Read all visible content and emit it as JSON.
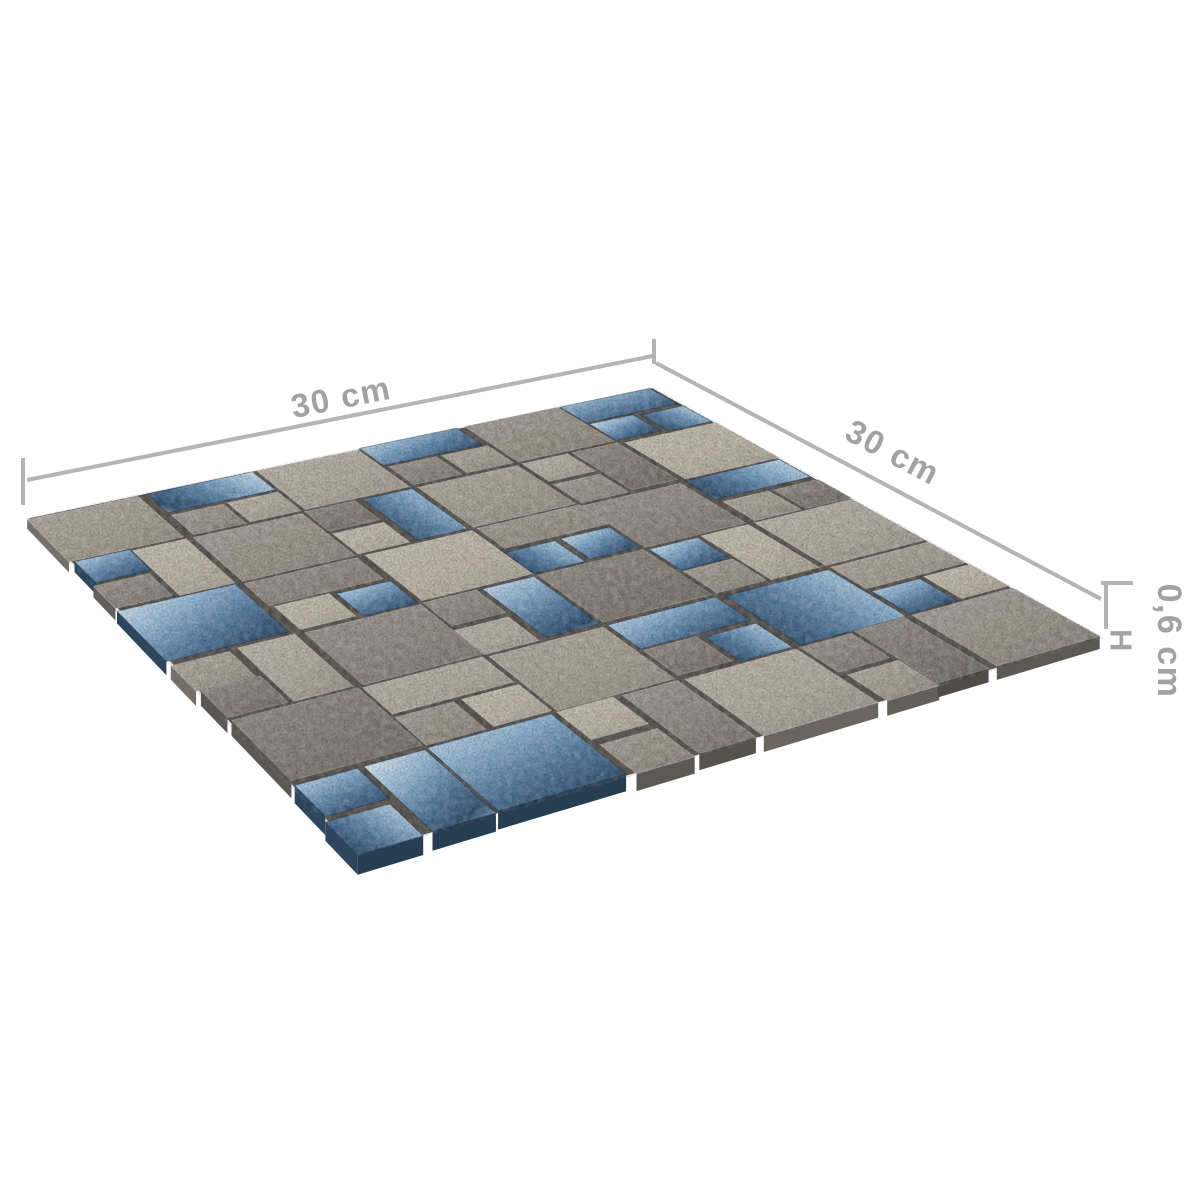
{
  "figure": {
    "type": "product-dimension-diagram",
    "product": "mosaic-tile-sheet",
    "background_color": "#ffffff",
    "sheet": {
      "corners": {
        "west": [
          25,
          518
        ],
        "north": [
          653,
          387
        ],
        "east": [
          1105,
          638
        ],
        "south": [
          358,
          856
        ]
      },
      "grid_units": 12,
      "grout_color": "#57524c",
      "stone_shades": [
        "#837d75",
        "#8f8880",
        "#9a938a",
        "#a59e94",
        "#b1a99f",
        "#bdb4a6"
      ],
      "glass_colors": {
        "light": "#dcebf5",
        "mid": "#93b7d4",
        "dark": "#54799e",
        "deep": "#31516f"
      },
      "edge_thickness_px": {
        "far": 5,
        "near": 20
      }
    },
    "tile_format": "[row, col, width, height, type(s=stone,g=glass), shade-or-glass-variant]",
    "tiles": [
      [
        0,
        0,
        2,
        2,
        "s",
        3
      ],
      [
        0,
        2,
        2,
        1,
        "g",
        1
      ],
      [
        1,
        2,
        1,
        1,
        "s",
        2
      ],
      [
        1,
        3,
        1,
        1,
        "s",
        4
      ],
      [
        2,
        0,
        1,
        1,
        "g",
        0
      ],
      [
        3,
        0,
        1,
        1,
        "s",
        1
      ],
      [
        2,
        1,
        1,
        2,
        "s",
        5
      ],
      [
        2,
        2,
        2,
        2,
        "s",
        2
      ],
      [
        0,
        4,
        2,
        2,
        "s",
        4
      ],
      [
        0,
        6,
        2,
        1,
        "g",
        2
      ],
      [
        1,
        6,
        1,
        1,
        "s",
        1
      ],
      [
        1,
        7,
        1,
        1,
        "s",
        3
      ],
      [
        2,
        4,
        1,
        1,
        "s",
        0
      ],
      [
        3,
        4,
        1,
        1,
        "s",
        5
      ],
      [
        2,
        5,
        1,
        2,
        "g",
        1
      ],
      [
        2,
        6,
        2,
        2,
        "s",
        3
      ],
      [
        0,
        8,
        2,
        2,
        "s",
        2
      ],
      [
        0,
        10,
        2,
        1,
        "g",
        0
      ],
      [
        1,
        10,
        1,
        1,
        "g",
        2
      ],
      [
        1,
        11,
        1,
        1,
        "g",
        1
      ],
      [
        2,
        8,
        1,
        1,
        "s",
        4
      ],
      [
        3,
        8,
        1,
        1,
        "s",
        2
      ],
      [
        2,
        9,
        1,
        2,
        "s",
        0
      ],
      [
        2,
        10,
        2,
        2,
        "s",
        5
      ],
      [
        4,
        0,
        2,
        2,
        "g",
        2
      ],
      [
        4,
        2,
        2,
        1,
        "s",
        1
      ],
      [
        5,
        2,
        1,
        1,
        "s",
        5
      ],
      [
        5,
        3,
        1,
        1,
        "g",
        0
      ],
      [
        6,
        0,
        1,
        1,
        "s",
        3
      ],
      [
        7,
        0,
        1,
        1,
        "s",
        0
      ],
      [
        6,
        1,
        1,
        2,
        "s",
        4
      ],
      [
        6,
        2,
        2,
        2,
        "s",
        1
      ],
      [
        4,
        4,
        2,
        2,
        "s",
        5
      ],
      [
        4,
        6,
        2,
        1,
        "s",
        2
      ],
      [
        5,
        6,
        1,
        1,
        "g",
        1
      ],
      [
        5,
        7,
        1,
        1,
        "g",
        2
      ],
      [
        6,
        4,
        1,
        1,
        "s",
        1
      ],
      [
        7,
        4,
        1,
        1,
        "s",
        4
      ],
      [
        6,
        5,
        1,
        2,
        "g",
        0
      ],
      [
        6,
        6,
        2,
        2,
        "s",
        0
      ],
      [
        4,
        8,
        2,
        2,
        "s",
        1
      ],
      [
        4,
        10,
        2,
        1,
        "g",
        1
      ],
      [
        5,
        10,
        1,
        1,
        "s",
        3
      ],
      [
        5,
        11,
        1,
        1,
        "s",
        0
      ],
      [
        6,
        8,
        1,
        1,
        "g",
        2
      ],
      [
        7,
        8,
        1,
        1,
        "s",
        2
      ],
      [
        6,
        9,
        1,
        2,
        "s",
        5
      ],
      [
        6,
        10,
        2,
        2,
        "s",
        4
      ],
      [
        8,
        0,
        2,
        2,
        "s",
        0
      ],
      [
        8,
        2,
        2,
        1,
        "s",
        4
      ],
      [
        9,
        2,
        1,
        1,
        "s",
        2
      ],
      [
        9,
        3,
        1,
        1,
        "s",
        5
      ],
      [
        10,
        0,
        1,
        1,
        "g",
        0
      ],
      [
        11,
        0,
        1,
        1,
        "g",
        1
      ],
      [
        10,
        1,
        1,
        2,
        "g",
        2
      ],
      [
        10,
        2,
        2,
        2,
        "g",
        0
      ],
      [
        8,
        4,
        2,
        2,
        "s",
        3
      ],
      [
        8,
        6,
        2,
        1,
        "g",
        2
      ],
      [
        9,
        6,
        1,
        1,
        "s",
        0
      ],
      [
        9,
        7,
        1,
        1,
        "g",
        1
      ],
      [
        10,
        4,
        1,
        1,
        "s",
        5
      ],
      [
        11,
        4,
        1,
        1,
        "s",
        2
      ],
      [
        10,
        5,
        1,
        2,
        "s",
        1
      ],
      [
        10,
        6,
        2,
        2,
        "s",
        4
      ],
      [
        8,
        8,
        2,
        2,
        "g",
        1
      ],
      [
        8,
        10,
        2,
        1,
        "s",
        3
      ],
      [
        9,
        10,
        1,
        1,
        "g",
        0
      ],
      [
        9,
        11,
        1,
        1,
        "s",
        5
      ],
      [
        10,
        8,
        1,
        1,
        "s",
        1
      ],
      [
        11,
        8,
        1,
        1,
        "s",
        3
      ],
      [
        10,
        9,
        1,
        2,
        "s",
        0
      ],
      [
        10,
        10,
        2,
        2,
        "s",
        2
      ]
    ],
    "dimensions": {
      "width_label": "30 cm",
      "depth_label": "30 cm",
      "height_label": "0,6 cm",
      "height_symbol": "H",
      "line_color": "#b6b4b2",
      "text_color": "#a2a2a2",
      "lines": [
        {
          "name": "width-dimension-line",
          "from": [
            27,
            480
          ],
          "to": [
            653,
            356
          ]
        },
        {
          "name": "width-start-tick",
          "from": [
            23,
            458
          ],
          "to": [
            23,
            505
          ]
        },
        {
          "name": "corner-bend-tick",
          "from": [
            654,
            339
          ],
          "to": [
            654,
            364
          ]
        },
        {
          "name": "depth-dimension-line",
          "from": [
            656,
            363
          ],
          "to": [
            1101,
            599
          ]
        },
        {
          "name": "height-top-tick",
          "from": [
            1101,
            583
          ],
          "to": [
            1133,
            583
          ]
        },
        {
          "name": "height-drop-line",
          "from": [
            1106,
            583
          ],
          "to": [
            1106,
            629
          ]
        }
      ],
      "labels": [
        {
          "name": "width-dimension-label",
          "pos": [
            341,
            397
          ],
          "rot": -11.3,
          "cls": "lbl32"
        },
        {
          "name": "depth-dimension-label",
          "pos": [
            893,
            452
          ],
          "rot": 28,
          "cls": "lbl32"
        },
        {
          "name": "height-dimension-label",
          "pos": [
            1169,
            641
          ],
          "rot": 90,
          "cls": "lbl34"
        },
        {
          "name": "height-symbol-label",
          "pos": [
            1121,
            641
          ],
          "rot": 90,
          "cls": "lbl30"
        }
      ]
    }
  }
}
